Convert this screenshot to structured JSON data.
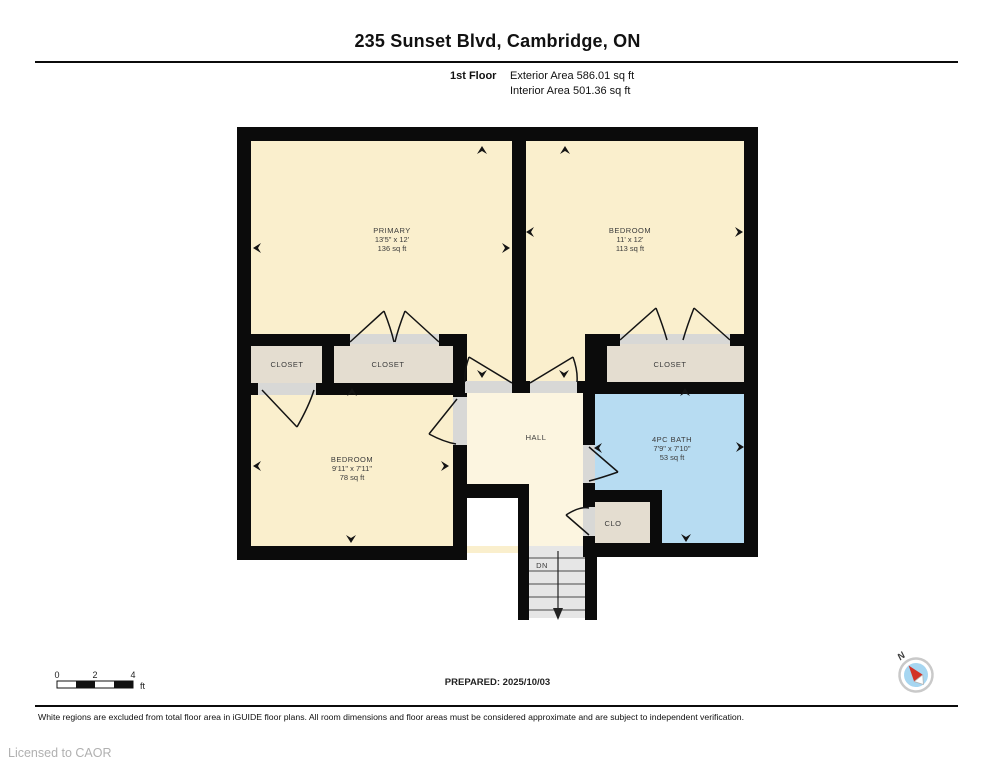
{
  "header": {
    "title": "235 Sunset Blvd, Cambridge, ON",
    "floor_label": "1st Floor",
    "exterior_area": "Exterior Area 586.01 sq ft",
    "interior_area": "Interior Area 501.36 sq ft"
  },
  "rooms": {
    "primary": {
      "name": "PRIMARY",
      "dims": "13'5\" x 12'",
      "area": "136 sq ft"
    },
    "bedroom2": {
      "name": "BEDROOM",
      "dims": "11' x 12'",
      "area": "113 sq ft"
    },
    "bedroom3": {
      "name": "BEDROOM",
      "dims": "9'11\" x 7'11\"",
      "area": "78 sq ft"
    },
    "bath": {
      "name": "4PC BATH",
      "dims": "7'9\" x 7'10\"",
      "area": "53 sq ft"
    },
    "hall": {
      "name": "HALL"
    },
    "closet_left": {
      "name": "CLOSET"
    },
    "closet_mid": {
      "name": "CLOSET"
    },
    "closet_right": {
      "name": "CLOSET"
    },
    "clo": {
      "name": "CLO"
    },
    "stairs": {
      "name": "DN"
    }
  },
  "scale_bar": {
    "tick0": "0",
    "tick2": "2",
    "tick4": "4",
    "unit": "ft"
  },
  "footer": {
    "prepared": "PREPARED: 2025/10/03",
    "disclaimer": "White regions are excluded from total floor area in iGUIDE floor plans. All room dimensions and floor areas must be considered approximate and are subject to independent verification.",
    "licensed": "Licensed to CAOR",
    "compass_label": "N"
  },
  "colors": {
    "wall": "#0b0b0b",
    "room_fill": "#faefcd",
    "hall_fill": "#fcf5e0",
    "closet_fill": "#e4ddd0",
    "bath_fill": "#b7dcf2",
    "window_blue": "#53a9da",
    "stair_fill": "#e6e6e6",
    "threshold": "#d8d8d6",
    "compass_red": "#d23227"
  }
}
